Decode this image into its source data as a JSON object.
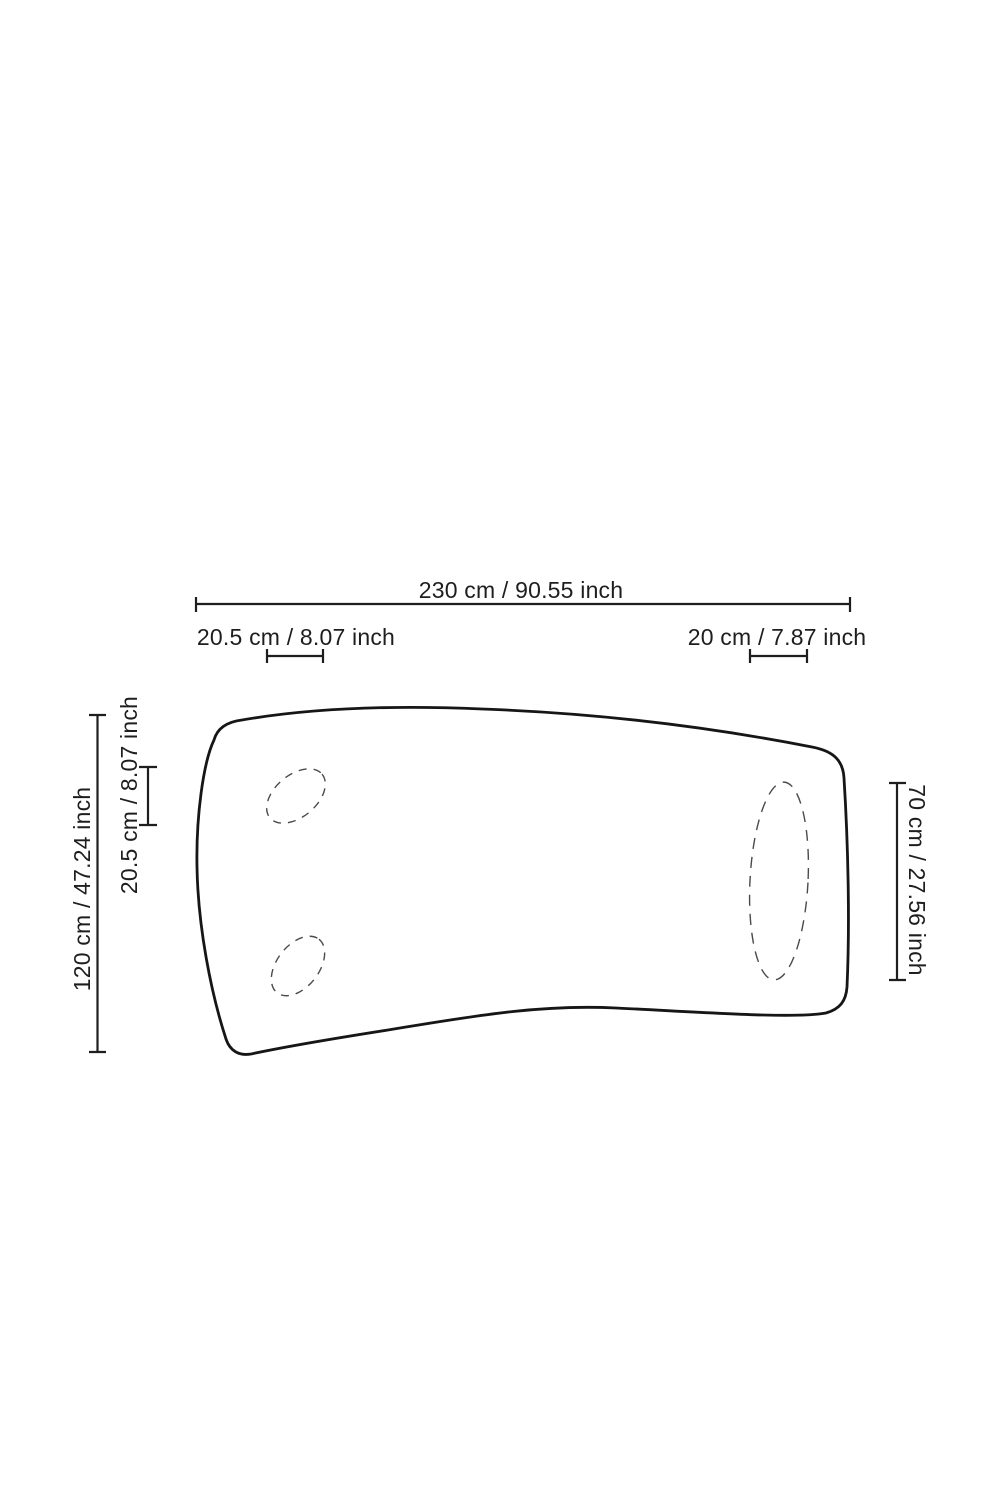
{
  "page": {
    "background": "#ffffff",
    "line_color": "#1e1e1e",
    "dash_color": "#4a4a4a"
  },
  "diagram": {
    "type": "furniture-dimension-drawing",
    "view": "table-top-plan-view",
    "labels": {
      "total_width": "230 cm / 90.55 inch",
      "left_leg_width": "20.5 cm / 8.07 inch",
      "right_leg_width": "20 cm / 7.87 inch",
      "total_depth": "120 cm / 47.24 inch",
      "left_leg_depth": "20.5 cm / 8.07 inch",
      "right_leg_depth": "70 cm / 27.56 inch"
    }
  }
}
